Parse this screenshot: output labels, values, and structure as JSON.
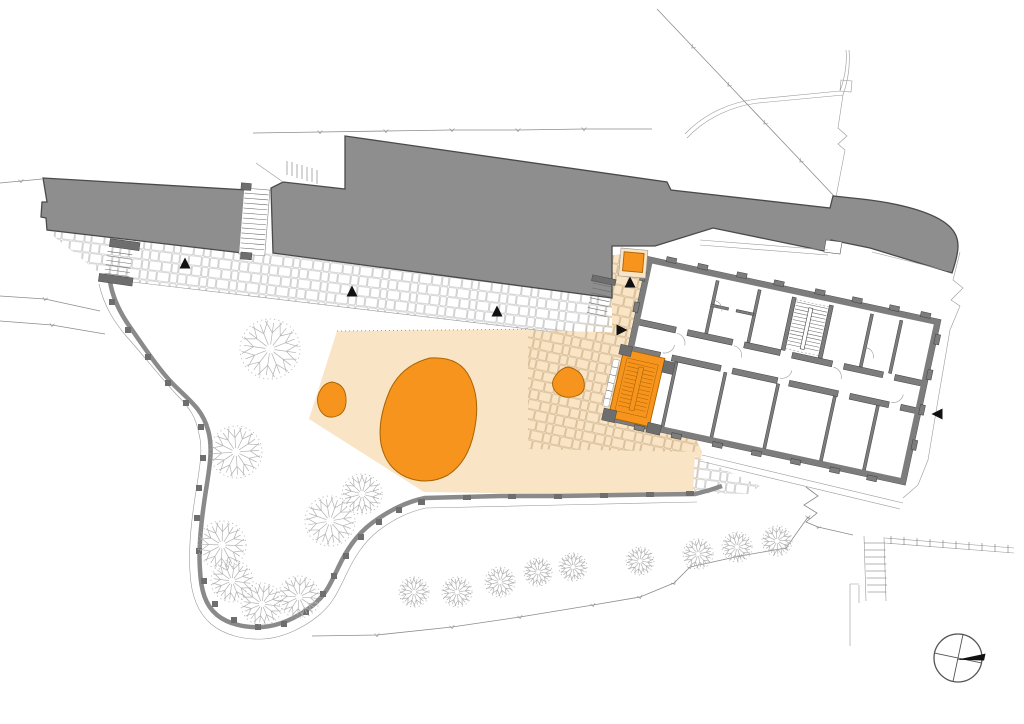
{
  "meta": {
    "drawing_type": "architectural-site-plan",
    "content": "ground floor plan with surrounding site, paved plaza, trees and retaining walls"
  },
  "palette": {
    "background": "#ffffff",
    "building_mass": "#8e8e8e",
    "building_outline": "#4a4a4a",
    "plan_wall": "#7d7d7d",
    "plan_wall_dark": "#3f3f3f",
    "accent_orange": "#f7941e",
    "accent_orange_outline": "#a96400",
    "paving_beige": "#f9e4c5",
    "stone_joint_white": "#b5b5b5",
    "stone_joint_beige": "#c7ab83",
    "site_line": "#8c8c8c",
    "wall_gray": "#8a8a8a",
    "pier_gray": "#6e6e6e",
    "tree_stroke": "#b3b3b3",
    "marker_black": "#111111"
  },
  "features": {
    "highlighted_elements": [
      "main-stair-block",
      "elevator-square",
      "large-plaza-blob",
      "small-plaza-blob-west",
      "small-plaza-blob-east"
    ],
    "building_count_gray_masses": 3,
    "detailed_plan_rotation_deg": 12.2
  },
  "trees": {
    "large": [
      {
        "x": 270,
        "y": 349,
        "r": 30
      },
      {
        "x": 236,
        "y": 452,
        "r": 26
      },
      {
        "x": 330,
        "y": 521,
        "r": 25
      },
      {
        "x": 222,
        "y": 545,
        "r": 24
      },
      {
        "x": 232,
        "y": 581,
        "r": 21
      },
      {
        "x": 262,
        "y": 604,
        "r": 21
      },
      {
        "x": 299,
        "y": 597,
        "r": 21
      },
      {
        "x": 362,
        "y": 494,
        "r": 20
      }
    ],
    "small": [
      {
        "x": 414,
        "y": 592,
        "r": 15
      },
      {
        "x": 457,
        "y": 592,
        "r": 15
      },
      {
        "x": 500,
        "y": 582,
        "r": 15
      },
      {
        "x": 538,
        "y": 572,
        "r": 14
      },
      {
        "x": 573,
        "y": 567,
        "r": 14
      },
      {
        "x": 640,
        "y": 561,
        "r": 14
      },
      {
        "x": 698,
        "y": 554,
        "r": 15
      },
      {
        "x": 737,
        "y": 547,
        "r": 15
      },
      {
        "x": 777,
        "y": 541,
        "r": 15
      }
    ]
  },
  "entrance_markers": [
    {
      "x": 185,
      "y": 264,
      "rotation": 0
    },
    {
      "x": 352,
      "y": 292,
      "rotation": 0
    },
    {
      "x": 497,
      "y": 312,
      "rotation": 0
    },
    {
      "x": 630,
      "y": 283,
      "rotation": 0
    },
    {
      "x": 621,
      "y": 330,
      "rotation": 90
    },
    {
      "x": 938,
      "y": 414,
      "rotation": -90
    }
  ],
  "compass": {
    "cx": 958,
    "cy": 658,
    "r": 24,
    "cross_angle": 12,
    "needle": "east"
  }
}
